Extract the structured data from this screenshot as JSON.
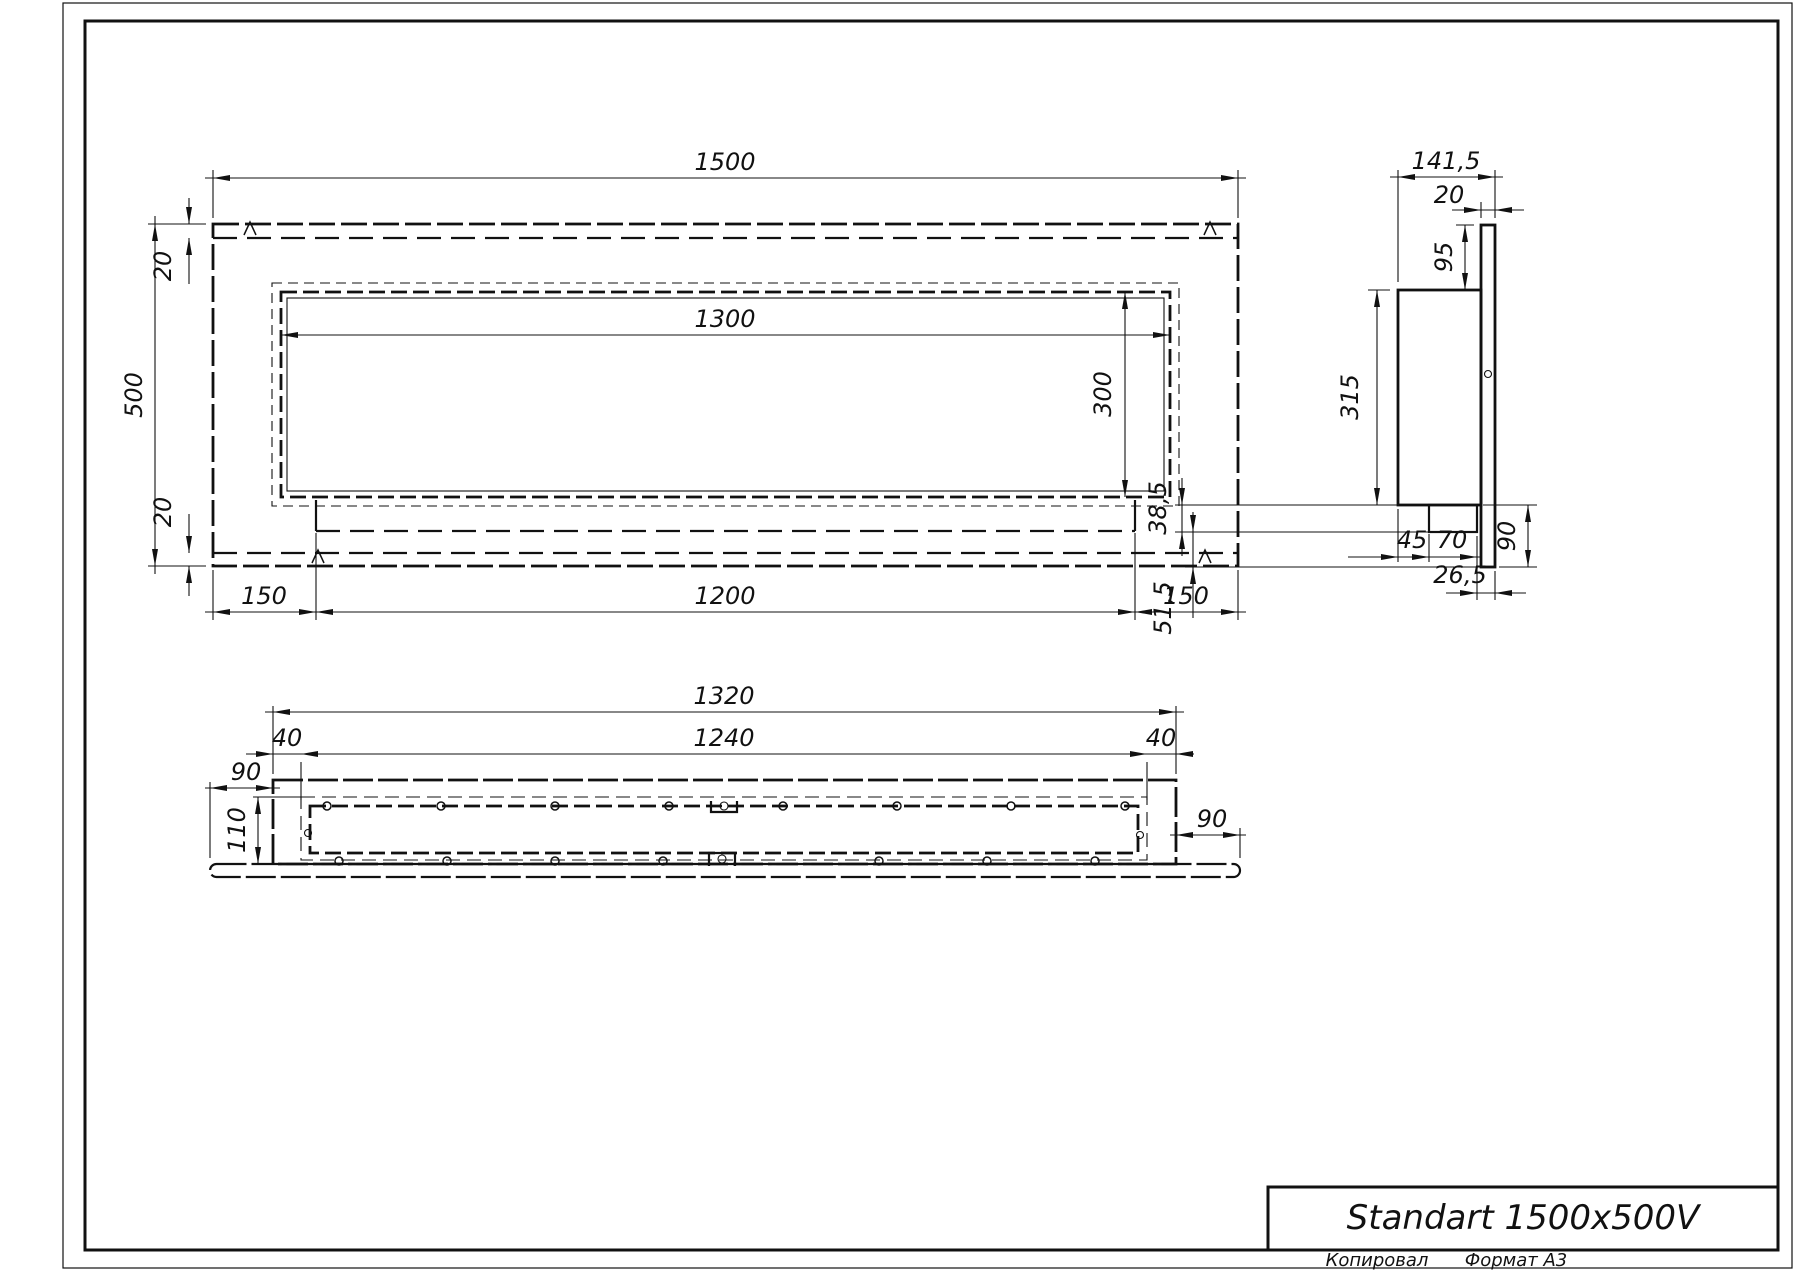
{
  "views": {
    "front": {
      "width": "1500",
      "height": "500",
      "top_margin": "20",
      "bottom_margin": "20",
      "opening_width": "1300",
      "opening_height": "300",
      "left_offset": "150",
      "slot_width": "1200",
      "right_offset": "150"
    },
    "side": {
      "depth": "141,5",
      "flange_thickness": "20",
      "top_inset": "95",
      "body_height": "315",
      "tray_drop": "38,5",
      "tray_offset": "45",
      "tray_width": "70",
      "flange_drop": "90",
      "lip_offset": "26,5",
      "bottom_drop": "51,5"
    },
    "bottom": {
      "body_width": "1320",
      "channel_width": "1240",
      "left_margin": "40",
      "right_margin": "40",
      "left_overhang": "90",
      "right_overhang": "90",
      "depth": "110"
    }
  },
  "title_block": {
    "title": "Standart 1500x500V"
  },
  "footer": {
    "copied_label": "Копировал",
    "format_label": "Формат А3"
  }
}
